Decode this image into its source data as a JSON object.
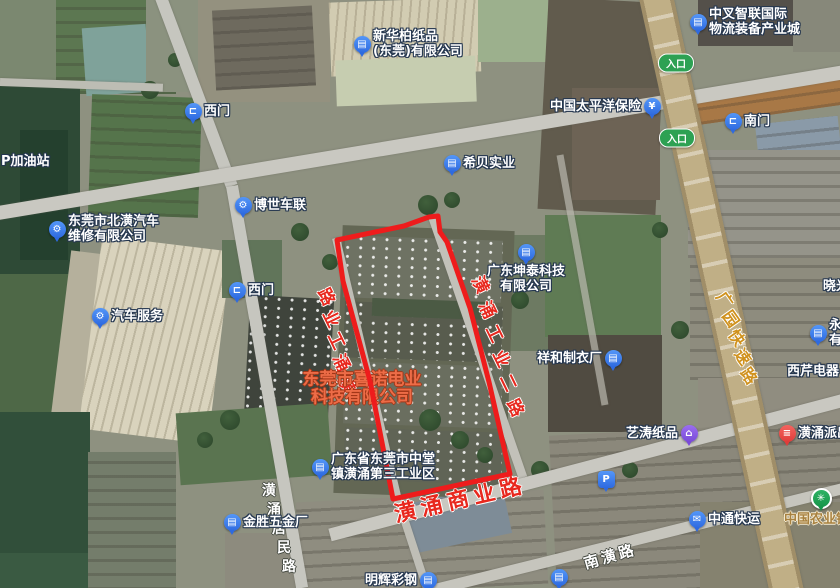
{
  "highlight": {
    "company_line1": "东莞市喜诺电业",
    "company_line2": "科技有限公司"
  },
  "entrance_label": "入口",
  "colors": {
    "boundary_red": "#ee1c1c",
    "road_label_red": "#e8281e",
    "expressway_label_gold": "#d0921e",
    "company_text_orange": "#ed6c47",
    "poi_blue": "#2e6ae0",
    "poi_purple": "#7a4ad8",
    "poi_red": "#e03c3a",
    "poi_green": "#17964a",
    "entrance_green": "#2da153"
  },
  "boundary": {
    "points": "337,240 404,226 429,217 438,216 440,232 447,242 470,308 489,382 510,474 393,499 370,381 343,281"
  },
  "road_labels": [
    {
      "id": "huangyong-gongye-yi-road",
      "name": "潢涌工业路",
      "type": "chars",
      "reverse": true,
      "x": 328,
      "y": 296,
      "dx": 5,
      "dy": 22,
      "rot": 64,
      "size": 17,
      "style": "red"
    },
    {
      "id": "huangyong-gongye-er-road",
      "name": "潢涌工业二路",
      "type": "chars",
      "reverse": false,
      "x": 482,
      "y": 284,
      "dx": 7,
      "dy": 24.5,
      "rot": 64,
      "size": 17,
      "style": "red"
    },
    {
      "id": "huangyong-shangye-road",
      "name": "潢涌商业路",
      "type": "line",
      "x": 460,
      "y": 498,
      "rot": -13,
      "size": 22,
      "spacing": 5,
      "style": "red"
    },
    {
      "id": "guangyuan-expressway",
      "name": "广园快速路",
      "type": "chars",
      "reverse": false,
      "x": 726,
      "y": 299,
      "dx": 6,
      "dy": 19,
      "rot": 55,
      "size": 16,
      "style": "gold"
    },
    {
      "id": "nanhuang-road",
      "name": "南潢路",
      "type": "line",
      "x": 610,
      "y": 556,
      "rot": -16,
      "size": 15,
      "spacing": 3,
      "style": "white"
    },
    {
      "id": "huangyong-jumin-road",
      "name": "潢涌居民路",
      "type": "chars",
      "reverse": false,
      "x": 269,
      "y": 490,
      "dx": 5,
      "dy": 19,
      "rot": 0,
      "size": 14,
      "style": "white"
    }
  ],
  "entrances": [
    {
      "x": 676,
      "y": 63
    },
    {
      "x": 677,
      "y": 138
    }
  ],
  "pois": [
    {
      "id": "xinhuabai",
      "x": 362,
      "y": 44,
      "icon": "building",
      "color": "blue",
      "side": "right",
      "lines": [
        "新华柏纸品",
        "(东莞)有限公司"
      ]
    },
    {
      "id": "zhongcha",
      "x": 698,
      "y": 22,
      "icon": "building",
      "color": "blue",
      "side": "right",
      "lines": [
        "中叉智联国际",
        "物流装备产业城"
      ]
    },
    {
      "id": "taipingyang",
      "x": 652,
      "y": 106,
      "icon": "money",
      "color": "blue",
      "side": "left",
      "lines": [
        "中国太平洋保险"
      ]
    },
    {
      "id": "nanmen",
      "x": 733,
      "y": 121,
      "icon": "gate",
      "color": "blue",
      "side": "right",
      "lines": [
        "南门"
      ]
    },
    {
      "id": "ximen-north",
      "x": 193,
      "y": 111,
      "icon": "gate",
      "color": "blue",
      "side": "right",
      "lines": [
        "西门"
      ]
    },
    {
      "id": "xibei",
      "x": 452,
      "y": 163,
      "icon": "building",
      "color": "blue",
      "side": "right",
      "lines": [
        "希贝实业"
      ]
    },
    {
      "id": "boshi",
      "x": 243,
      "y": 205,
      "icon": "car",
      "color": "blue",
      "side": "right",
      "lines": [
        "博世车联"
      ]
    },
    {
      "id": "beihuang",
      "x": 57,
      "y": 229,
      "icon": "car",
      "color": "blue",
      "side": "right",
      "lines": [
        "东莞市北潢汽车",
        "维修有限公司"
      ]
    },
    {
      "id": "ximen-west",
      "x": 237,
      "y": 290,
      "icon": "gate",
      "color": "blue",
      "side": "right",
      "lines": [
        "西门"
      ]
    },
    {
      "id": "qichefuwu",
      "x": 100,
      "y": 316,
      "icon": "car",
      "color": "blue",
      "side": "right",
      "lines": [
        "汽车服务"
      ]
    },
    {
      "id": "kuntai",
      "x": 526,
      "y": 252,
      "icon": "building",
      "color": "blue",
      "side": "below",
      "lines": [
        "广东坤泰科技",
        "有限公司"
      ]
    },
    {
      "id": "xianghe",
      "x": 613,
      "y": 358,
      "icon": "building",
      "color": "blue",
      "side": "left",
      "lines": [
        "祥和制衣厂"
      ]
    },
    {
      "id": "yong",
      "x": 818,
      "y": 333,
      "icon": "building",
      "color": "blue",
      "side": "right",
      "lines": [
        "永",
        "有"
      ]
    },
    {
      "id": "xiqin",
      "x": 776,
      "y": 371,
      "icon": "none",
      "side": "right",
      "lines": [
        "西芹电器"
      ]
    },
    {
      "id": "xiaoguang",
      "x": 812,
      "y": 286,
      "icon": "none",
      "side": "right",
      "lines": [
        "晓光"
      ]
    },
    {
      "id": "yitao",
      "x": 689,
      "y": 433,
      "icon": "shop",
      "color": "purple",
      "side": "left",
      "lines": [
        "艺涛纸品"
      ]
    },
    {
      "id": "paichusuo",
      "x": 787,
      "y": 433,
      "icon": "police",
      "color": "red",
      "side": "right",
      "lines": [
        "潢涌派出所"
      ]
    },
    {
      "id": "parking",
      "x": 606,
      "y": 479,
      "icon": "parking",
      "color": "blue",
      "side": "right",
      "lines": []
    },
    {
      "id": "zhongtong",
      "x": 697,
      "y": 519,
      "icon": "truck",
      "color": "blue",
      "side": "right",
      "lines": [
        "中通快运"
      ]
    },
    {
      "id": "abc-bank",
      "x": 821,
      "y": 498,
      "icon": "bank",
      "color": "green",
      "side": "custom",
      "lx": 784,
      "ly": 519,
      "labelStyle": "tan",
      "lines": [
        "中国农业银行"
      ]
    },
    {
      "id": "gongyequ",
      "x": 320,
      "y": 467,
      "icon": "building",
      "color": "blue",
      "side": "right",
      "lines": [
        "广东省东莞市中堂",
        "镇潢涌第三工业区"
      ]
    },
    {
      "id": "jinsheng",
      "x": 232,
      "y": 522,
      "icon": "building",
      "color": "blue",
      "side": "right",
      "lines": [
        "金胜五金厂"
      ]
    },
    {
      "id": "minghui",
      "x": 428,
      "y": 580,
      "icon": "building",
      "color": "blue",
      "side": "left",
      "lines": [
        "明辉彩钢"
      ]
    },
    {
      "id": "poi-south",
      "x": 559,
      "y": 577,
      "icon": "building",
      "color": "blue",
      "side": "right",
      "lines": []
    },
    {
      "id": "jiayouzhan",
      "x": -10,
      "y": 161,
      "icon": "none",
      "side": "right",
      "lines": [
        "P加油站"
      ]
    }
  ]
}
